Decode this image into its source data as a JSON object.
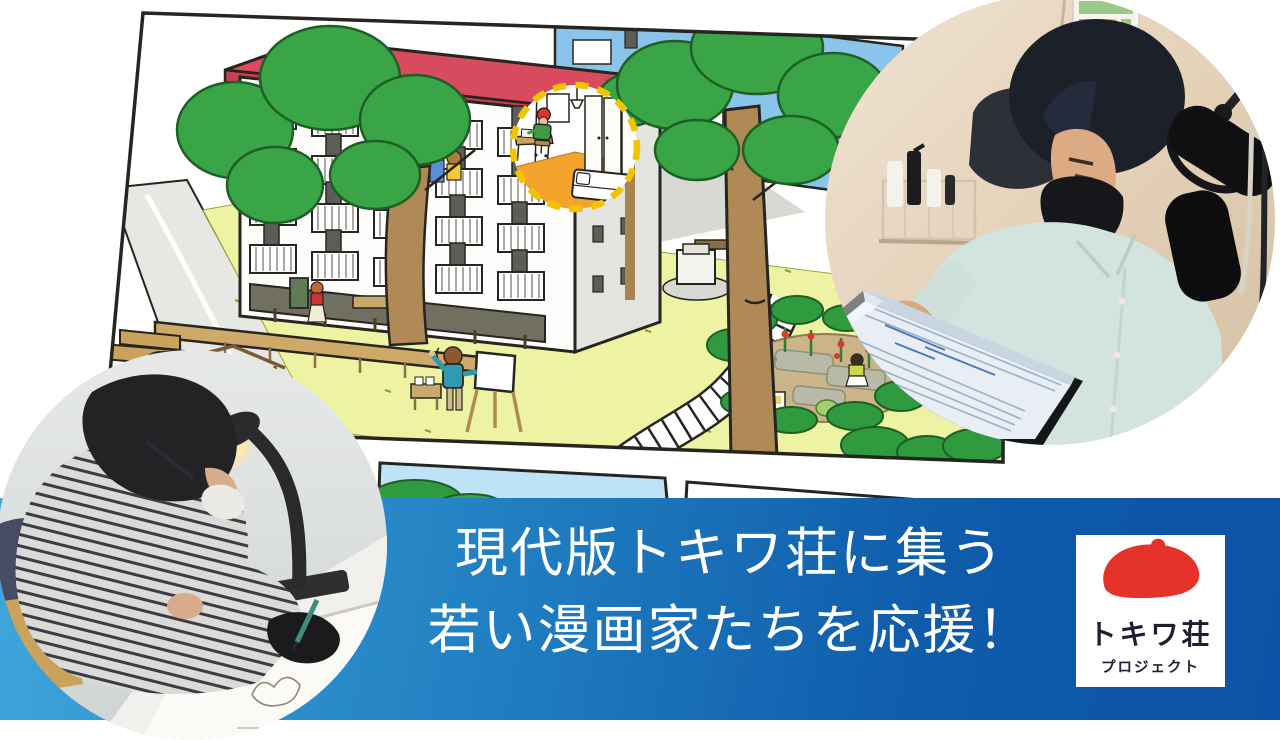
{
  "banner": {
    "line1": "現代版トキワ荘に集う",
    "line2": "若い漫画家たちを応援！",
    "text_color": "#ffffff",
    "gradient_left": "#3fa6da",
    "gradient_right": "#0d52a6"
  },
  "logo": {
    "title": "トキワ荘",
    "subtitle": "プロジェクト",
    "beret_color": "#e6332a",
    "text_color": "#1d1e32",
    "background": "#ffffff"
  },
  "illustration": {
    "roof_color": "#d84a5e",
    "building_color": "#fdfdfb",
    "accent_building_color": "#8ac4ea",
    "grass_color": "#eef3a4",
    "tree_color": "#3aa546",
    "trunk_color": "#b08a56",
    "car_color": "#f3c41c",
    "deck_color": "#cfa96a",
    "inset_floor_color": "#f3a42c",
    "inset_ring_color": "#f2c300",
    "outline_color": "#26251f"
  }
}
